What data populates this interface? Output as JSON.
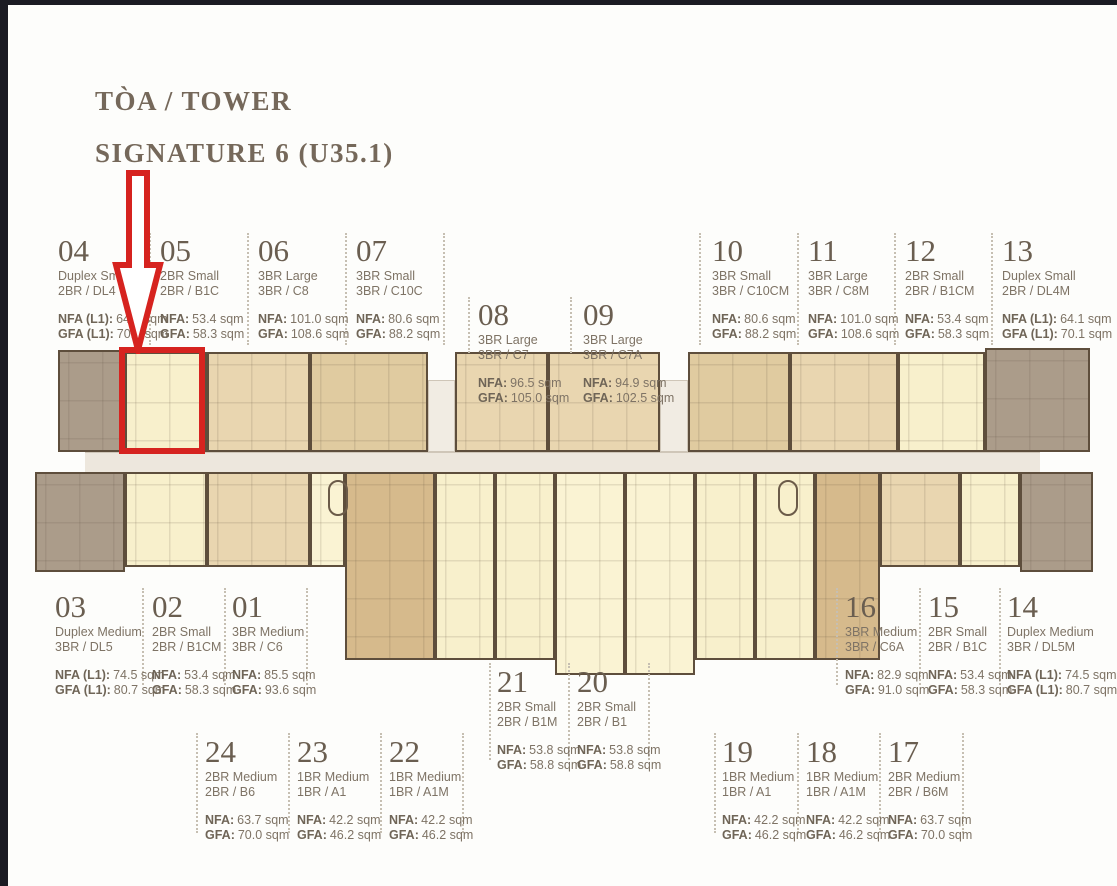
{
  "title": {
    "line1": "TÒA / TOWER",
    "line2": "SIGNATURE 6 (U35.1)"
  },
  "colors": {
    "highlight_red": "#d6231f",
    "wall": "#5e4e3c",
    "duplex_fill": "#ab9c8a",
    "cream_fill": "#f8f0cc",
    "tan_fill": "#e9d6b0",
    "dark_tan_fill": "#d6ba8c",
    "corridor_fill": "#ede7dd",
    "text_brown": "#75685a",
    "frame_black": "#1b1b23"
  },
  "units": [
    {
      "no": "04",
      "type": "Duplex Small",
      "code": "2BR / DL4",
      "nfa_label": "NFA (L1):",
      "nfa_value": "64.1 sqm",
      "gfa_label": "GFA (L1):",
      "gfa_value": "70.1 sqm"
    },
    {
      "no": "05",
      "type": "2BR Small",
      "code": "2BR / B1C",
      "nfa_label": "NFA:",
      "nfa_value": "53.4 sqm",
      "gfa_label": "GFA:",
      "gfa_value": "58.3 sqm"
    },
    {
      "no": "06",
      "type": "3BR Large",
      "code": "3BR / C8",
      "nfa_label": "NFA:",
      "nfa_value": "101.0 sqm",
      "gfa_label": "GFA:",
      "gfa_value": "108.6 sqm"
    },
    {
      "no": "07",
      "type": "3BR Small",
      "code": "3BR / C10C",
      "nfa_label": "NFA:",
      "nfa_value": "80.6 sqm",
      "gfa_label": "GFA:",
      "gfa_value": "88.2 sqm"
    },
    {
      "no": "08",
      "type": "3BR Large",
      "code": "3BR / C7",
      "nfa_label": "NFA:",
      "nfa_value": "96.5 sqm",
      "gfa_label": "GFA:",
      "gfa_value": "105.0 sqm"
    },
    {
      "no": "09",
      "type": "3BR Large",
      "code": "3BR / C7A",
      "nfa_label": "NFA:",
      "nfa_value": "94.9 sqm",
      "gfa_label": "GFA:",
      "gfa_value": "102.5 sqm"
    },
    {
      "no": "10",
      "type": "3BR Small",
      "code": "3BR / C10CM",
      "nfa_label": "NFA:",
      "nfa_value": "80.6 sqm",
      "gfa_label": "GFA:",
      "gfa_value": "88.2 sqm"
    },
    {
      "no": "11",
      "type": "3BR Large",
      "code": "3BR / C8M",
      "nfa_label": "NFA:",
      "nfa_value": "101.0 sqm",
      "gfa_label": "GFA:",
      "gfa_value": "108.6 sqm"
    },
    {
      "no": "12",
      "type": "2BR Small",
      "code": "2BR / B1CM",
      "nfa_label": "NFA:",
      "nfa_value": "53.4 sqm",
      "gfa_label": "GFA:",
      "gfa_value": "58.3 sqm"
    },
    {
      "no": "13",
      "type": "Duplex Small",
      "code": "2BR / DL4M",
      "nfa_label": "NFA (L1):",
      "nfa_value": "64.1 sqm",
      "gfa_label": "GFA (L1):",
      "gfa_value": "70.1 sqm"
    },
    {
      "no": "03",
      "type": "Duplex Medium",
      "code": "3BR / DL5",
      "nfa_label": "NFA (L1):",
      "nfa_value": "74.5 sqm",
      "gfa_label": "GFA (L1):",
      "gfa_value": "80.7 sqm"
    },
    {
      "no": "02",
      "type": "2BR Small",
      "code": "2BR / B1CM",
      "nfa_label": "NFA:",
      "nfa_value": "53.4 sqm",
      "gfa_label": "GFA:",
      "gfa_value": "58.3 sqm"
    },
    {
      "no": "01",
      "type": "3BR Medium",
      "code": "3BR / C6",
      "nfa_label": "NFA:",
      "nfa_value": "85.5 sqm",
      "gfa_label": "GFA:",
      "gfa_value": "93.6 sqm"
    },
    {
      "no": "16",
      "type": "3BR Medium",
      "code": "3BR / C6A",
      "nfa_label": "NFA:",
      "nfa_value": "82.9 sqm",
      "gfa_label": "GFA:",
      "gfa_value": "91.0 sqm"
    },
    {
      "no": "15",
      "type": "2BR Small",
      "code": "2BR / B1C",
      "nfa_label": "NFA:",
      "nfa_value": "53.4 sqm",
      "gfa_label": "GFA:",
      "gfa_value": "58.3 sqm"
    },
    {
      "no": "14",
      "type": "Duplex Medium",
      "code": "3BR / DL5M",
      "nfa_label": "NFA (L1):",
      "nfa_value": "74.5 sqm",
      "gfa_label": "GFA (L1):",
      "gfa_value": "80.7 sqm"
    },
    {
      "no": "24",
      "type": "2BR Medium",
      "code": "2BR / B6",
      "nfa_label": "NFA:",
      "nfa_value": "63.7 sqm",
      "gfa_label": "GFA:",
      "gfa_value": "70.0 sqm"
    },
    {
      "no": "23",
      "type": "1BR Medium",
      "code": "1BR / A1",
      "nfa_label": "NFA:",
      "nfa_value": "42.2 sqm",
      "gfa_label": "GFA:",
      "gfa_value": "46.2 sqm"
    },
    {
      "no": "22",
      "type": "1BR Medium",
      "code": "1BR / A1M",
      "nfa_label": "NFA:",
      "nfa_value": "42.2 sqm",
      "gfa_label": "GFA:",
      "gfa_value": "46.2 sqm"
    },
    {
      "no": "21",
      "type": "2BR Small",
      "code": "2BR / B1M",
      "nfa_label": "NFA:",
      "nfa_value": "53.8 sqm",
      "gfa_label": "GFA:",
      "gfa_value": "58.8 sqm"
    },
    {
      "no": "20",
      "type": "2BR Small",
      "code": "2BR / B1",
      "nfa_label": "NFA:",
      "nfa_value": "53.8 sqm",
      "gfa_label": "GFA:",
      "gfa_value": "58.8 sqm"
    },
    {
      "no": "19",
      "type": "1BR Medium",
      "code": "1BR / A1",
      "nfa_label": "NFA:",
      "nfa_value": "42.2 sqm",
      "gfa_label": "GFA:",
      "gfa_value": "46.2 sqm"
    },
    {
      "no": "18",
      "type": "1BR Medium",
      "code": "1BR / A1M",
      "nfa_label": "NFA:",
      "nfa_value": "42.2 sqm",
      "gfa_label": "GFA:",
      "gfa_value": "46.2 sqm"
    },
    {
      "no": "17",
      "type": "2BR Medium",
      "code": "2BR / B6M",
      "nfa_label": "NFA:",
      "nfa_value": "63.7 sqm",
      "gfa_label": "GFA:",
      "gfa_value": "70.0 sqm"
    }
  ]
}
